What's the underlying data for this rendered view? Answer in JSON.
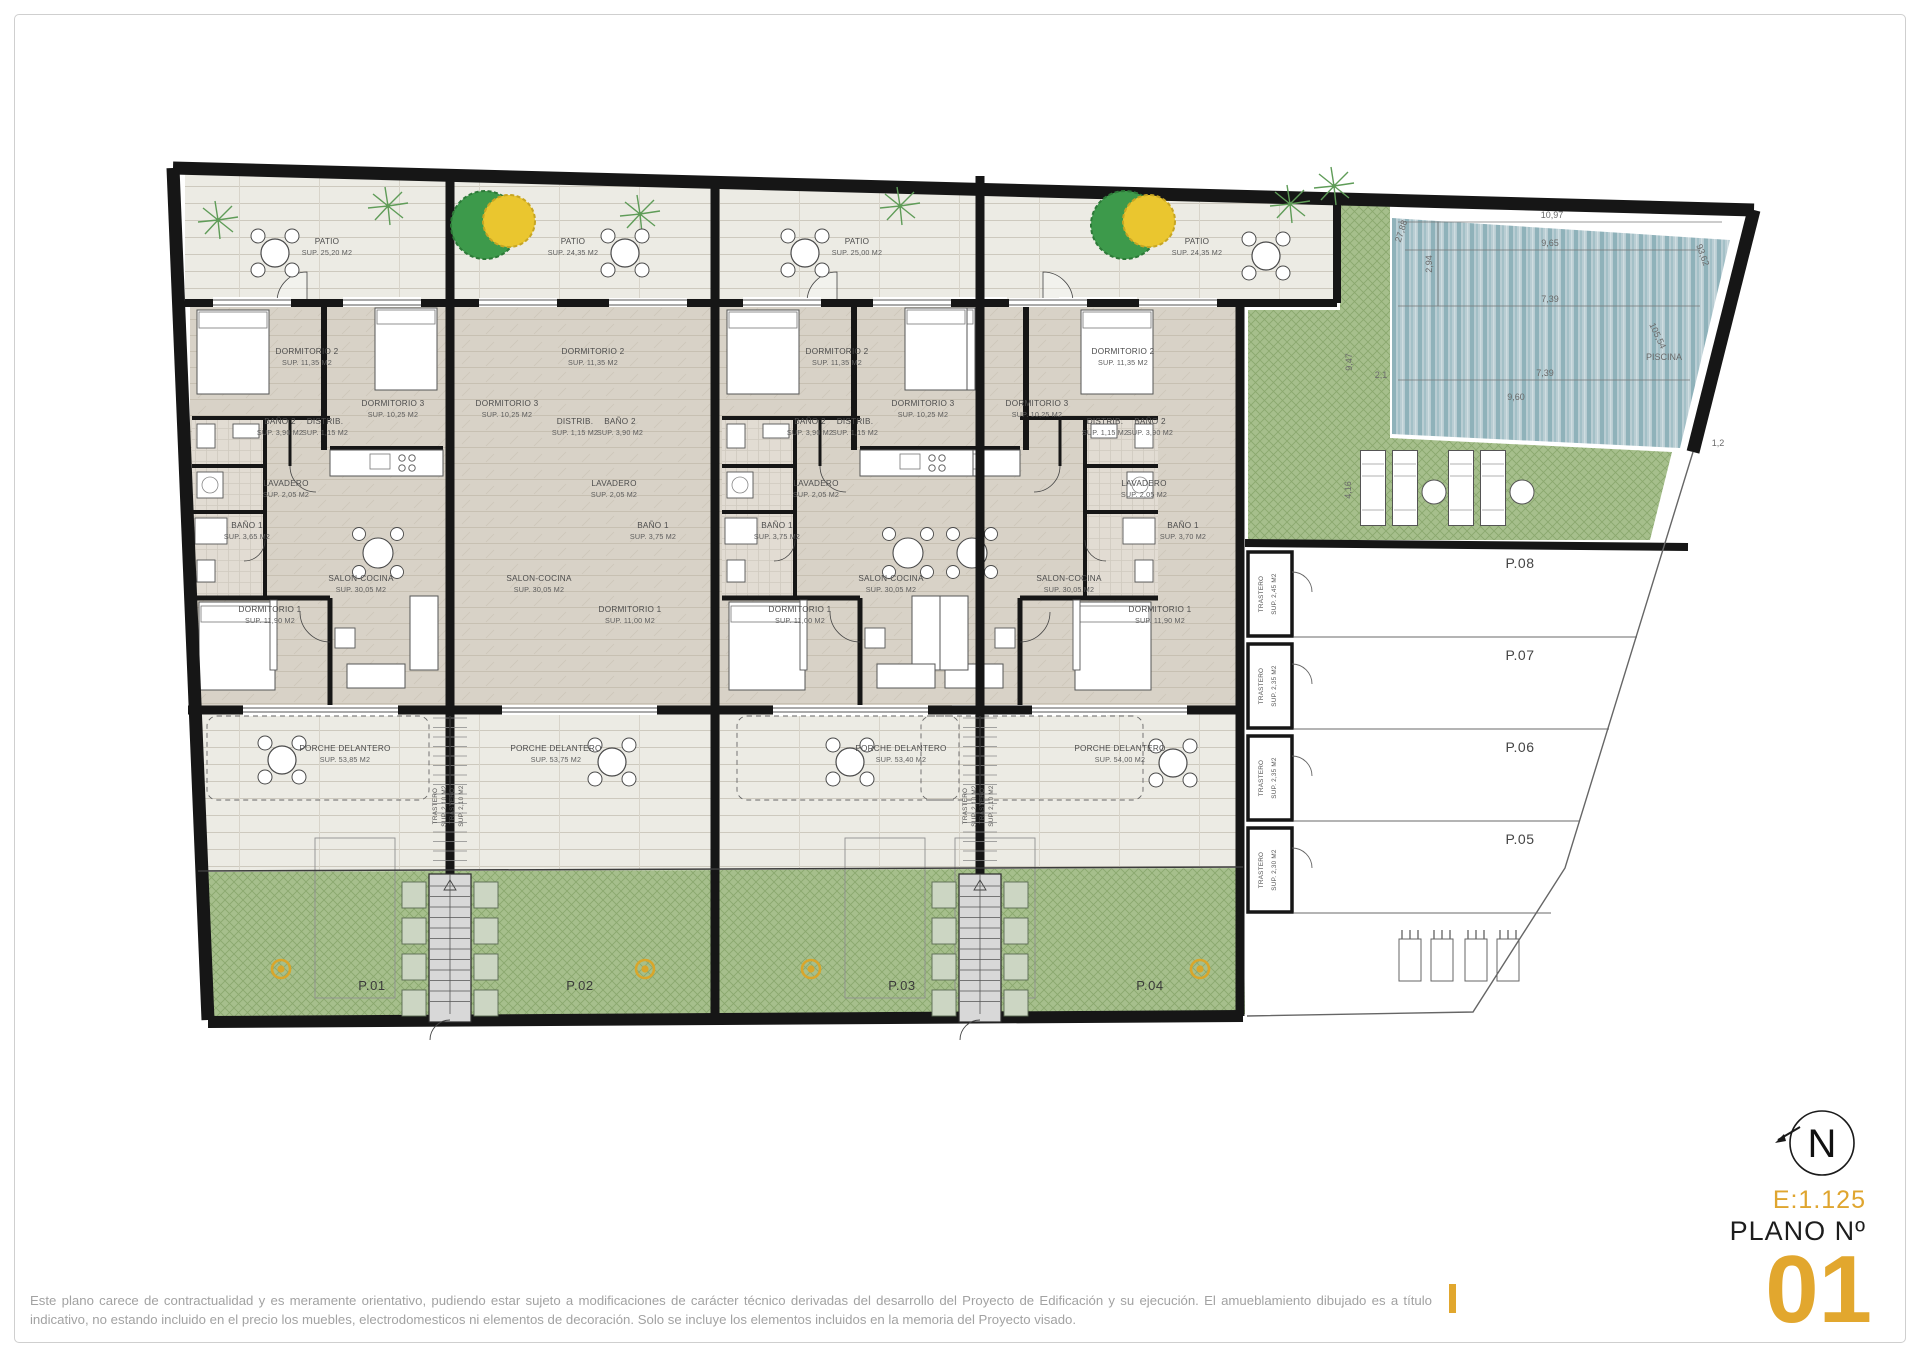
{
  "page": {
    "disclaimer_line1": "Este plano carece de contractualidad y es meramente orientativo, pudiendo estar sujeto a modificaciones de carácter técnico derivadas del desarrollo del Proyecto de Edificación y su ejecución. El amueblamiento dibujado es a título",
    "disclaimer_line2": "indicativo, no estando incluido en el precio los muebles, electrodomesticos ni elementos de decoración. Solo se incluye los elementos incluidos en la memoria del Proyecto visado."
  },
  "title_block": {
    "scale": "E:1.125",
    "plano_label": "PLANO Nº",
    "plano_number": "01",
    "north": "N"
  },
  "stair_trastero": {
    "label": "TRASTERO",
    "sup": "SUP. 2,10 M2"
  },
  "units": [
    {
      "garden_label": "P.01",
      "patio": {
        "label": "PATIO",
        "sup": "SUP. 25,20 M2"
      },
      "dormitorio2": {
        "label": "DORMITORIO 2",
        "sup": "SUP. 11,35 M2"
      },
      "dormitorio3": {
        "label": "DORMITORIO 3",
        "sup": "SUP. 10,25 M2"
      },
      "bano2": {
        "label": "BAÑO 2",
        "sup": "SUP. 3,90 M2"
      },
      "distrib": {
        "label": "DISTRIB.",
        "sup": "SUP. 1,15 M2"
      },
      "lavadero": {
        "label": "LAVADERO",
        "sup": "SUP. 2,05 M2"
      },
      "bano1": {
        "label": "BAÑO 1",
        "sup": "SUP. 3,65 M2"
      },
      "salon": {
        "label": "SALON-COCINA",
        "sup": "SUP. 30,05 M2"
      },
      "dormitorio1": {
        "label": "DORMITORIO 1",
        "sup": "SUP. 11,90 M2"
      },
      "porche": {
        "label": "PORCHE DELANTERO",
        "sup": "SUP. 53,85 M2"
      }
    },
    {
      "garden_label": "P.02",
      "patio": {
        "label": "PATIO",
        "sup": "SUP. 24,35 M2"
      },
      "dormitorio2": {
        "label": "DORMITORIO 2",
        "sup": "SUP. 11,35 M2"
      },
      "dormitorio3": {
        "label": "DORMITORIO 3",
        "sup": "SUP. 10,25 M2"
      },
      "bano2": {
        "label": "BAÑO 2",
        "sup": "SUP. 3,90 M2"
      },
      "distrib": {
        "label": "DISTRIB.",
        "sup": "SUP. 1,15 M2"
      },
      "lavadero": {
        "label": "LAVADERO",
        "sup": "SUP. 2,05 M2"
      },
      "bano1": {
        "label": "BAÑO 1",
        "sup": "SUP. 3,75 M2"
      },
      "salon": {
        "label": "SALON-COCINA",
        "sup": "SUP. 30,05 M2"
      },
      "dormitorio1": {
        "label": "DORMITORIO 1",
        "sup": "SUP. 11,00 M2"
      },
      "porche": {
        "label": "PORCHE DELANTERO",
        "sup": "SUP. 53,75 M2"
      }
    },
    {
      "garden_label": "P.03",
      "patio": {
        "label": "PATIO",
        "sup": "SUP. 25,00 M2"
      },
      "dormitorio2": {
        "label": "DORMITORIO 2",
        "sup": "SUP. 11,35 M2"
      },
      "dormitorio3": {
        "label": "DORMITORIO 3",
        "sup": "SUP. 10,25 M2"
      },
      "bano2": {
        "label": "BAÑO 2",
        "sup": "SUP. 3,90 M2"
      },
      "distrib": {
        "label": "DISTRIB.",
        "sup": "SUP. 1,15 M2"
      },
      "lavadero": {
        "label": "LAVADERO",
        "sup": "SUP. 2,05 M2"
      },
      "bano1": {
        "label": "BAÑO 1",
        "sup": "SUP. 3,75 M2"
      },
      "salon": {
        "label": "SALON-COCINA",
        "sup": "SUP. 30,05 M2"
      },
      "dormitorio1": {
        "label": "DORMITORIO 1",
        "sup": "SUP. 11,00 M2"
      },
      "porche": {
        "label": "PORCHE DELANTERO",
        "sup": "SUP. 53,40 M2"
      }
    },
    {
      "garden_label": "P.04",
      "patio": {
        "label": "PATIO",
        "sup": "SUP. 24,35 M2"
      },
      "dormitorio2": {
        "label": "DORMITORIO 2",
        "sup": "SUP. 11,35 M2"
      },
      "dormitorio3": {
        "label": "DORMITORIO 3",
        "sup": "SUP. 10,25 M2"
      },
      "bano2": {
        "label": "BAÑO 2",
        "sup": "SUP. 3,90 M2"
      },
      "distrib": {
        "label": "DISTRIB.",
        "sup": "SUP. 1,15 M2"
      },
      "lavadero": {
        "label": "LAVADERO",
        "sup": "SUP. 2,05 M2"
      },
      "bano1": {
        "label": "BAÑO 1",
        "sup": "SUP. 3,70 M2"
      },
      "salon": {
        "label": "SALON-COCINA",
        "sup": "SUP. 30,05 M2"
      },
      "dormitorio1": {
        "label": "DORMITORIO 1",
        "sup": "SUP. 11,90 M2"
      },
      "porche": {
        "label": "PORCHE DELANTERO",
        "sup": "SUP. 54,00 M2"
      }
    }
  ],
  "right_zone": {
    "trasteros": [
      {
        "label": "TRASTERO",
        "sup": "SUP. 2,45 M2"
      },
      {
        "label": "TRASTERO",
        "sup": "SUP. 2,35 M2"
      },
      {
        "label": "TRASTERO",
        "sup": "SUP. 2,35 M2"
      },
      {
        "label": "TRASTERO",
        "sup": "SUP. 2,30 M2"
      }
    ],
    "parking": [
      "P.08",
      "P.07",
      "P.06",
      "P.05"
    ],
    "pool": {
      "label": "PISCINA",
      "dims": {
        "top": "10,97",
        "second": "9,65",
        "middle": "7,39",
        "left_v": "2,94",
        "diag": "27,88",
        "angle_tr": "93,62",
        "angle_br": "105,54",
        "bottom": "7,39",
        "below": "9,60",
        "left_out_v": "9,47",
        "small": "2,1",
        "green_v": "4,16",
        "right_small": "1,2"
      }
    }
  }
}
